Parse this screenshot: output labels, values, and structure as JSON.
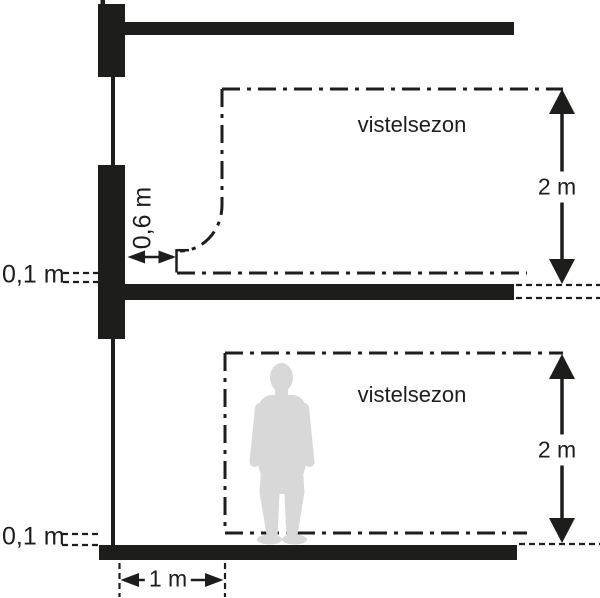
{
  "labels": {
    "upper_zone_label": "vistelsezon",
    "lower_zone_label": "vistelsezon",
    "upper_zone_height": "2 m",
    "lower_zone_height": "2 m",
    "upper_floor_clearance": "0,1 m",
    "lower_floor_clearance": "0,1 m",
    "window_wall_clearance": "0,6 m",
    "door_clearance": "1 m"
  },
  "colors": {
    "ink": "#1d1d1b",
    "silhouette": "#d8d8d8",
    "background": "#ffffff"
  }
}
